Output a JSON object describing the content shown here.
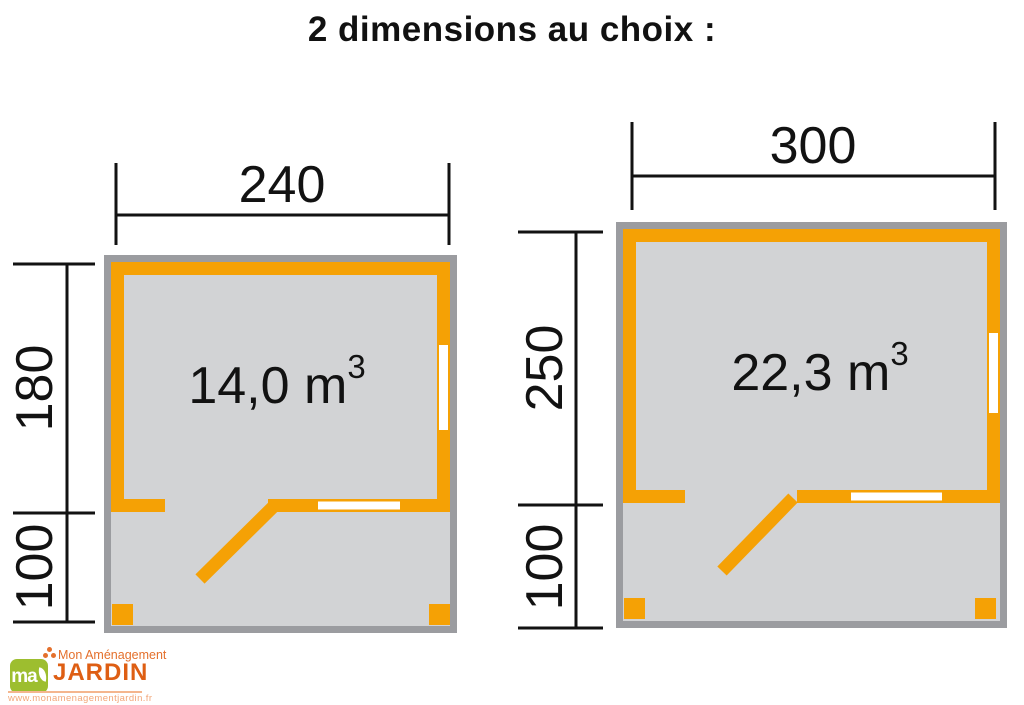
{
  "title": "2 dimensions au choix :",
  "plans": [
    {
      "id": "small",
      "width": "240",
      "depth": "180",
      "porch": "100",
      "volume": "14,0 m",
      "volume_sup": "3"
    },
    {
      "id": "large",
      "width": "300",
      "depth": "250",
      "porch": "100",
      "volume": "22,3 m",
      "volume_sup": "3"
    }
  ],
  "logo": {
    "monogram": "ma",
    "name_line1": "Mon Aménagement",
    "name_line2": "JARDIN",
    "website": "www.monamenagementjardin.fr"
  },
  "colors": {
    "wall_orange": "#F5A105",
    "outline_gray": "#9B9CA0",
    "floor_gray": "#D2D3D5",
    "window_white": "#FFFFFF",
    "text_black": "#121212",
    "logo_green": "#9DBE2F",
    "logo_orange": "#E4702C",
    "logo_orange_dark": "#DE5E13"
  }
}
